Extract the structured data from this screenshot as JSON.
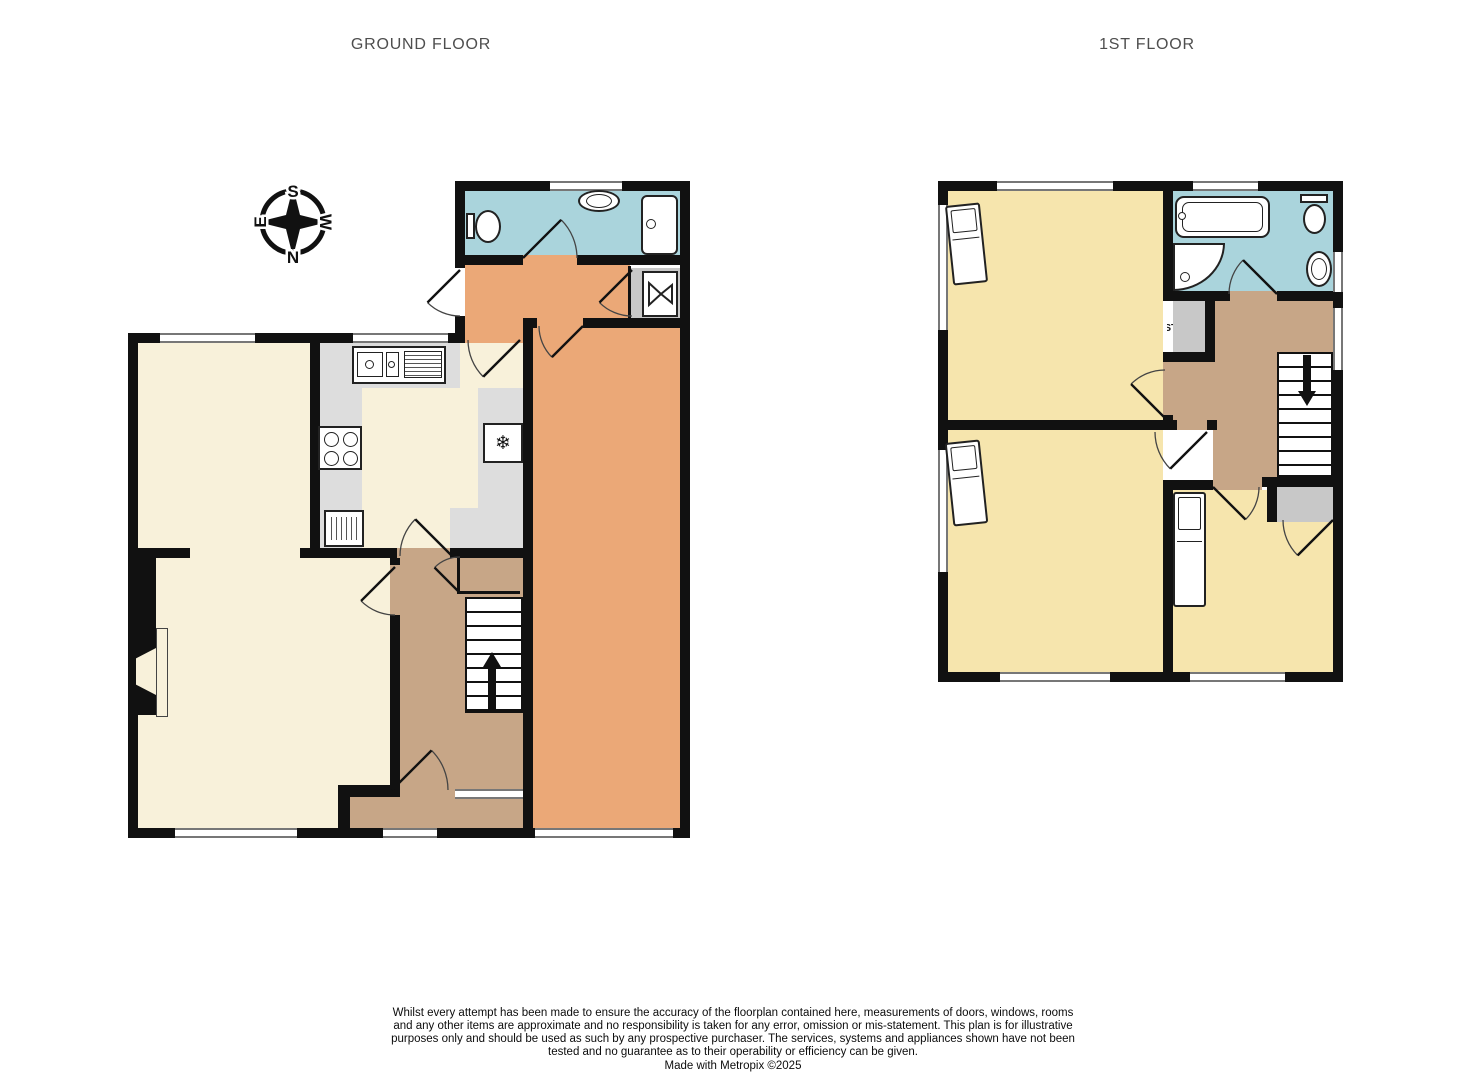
{
  "titles": {
    "ground": "GROUND FLOOR",
    "first": "1ST FLOOR"
  },
  "compass": {
    "north": "N",
    "south": "S",
    "east": "E",
    "west": "W"
  },
  "ground_floor": {
    "wc": "WC",
    "utility": "UTILITY",
    "storage_utility": "STORAGE",
    "garage": "GARAGE",
    "kitchen": "KITCHEN",
    "dining_room": "DINING ROOM",
    "lounge": "LOUNGE",
    "hall": "HALL",
    "storage_hall": "STORAGE",
    "porch": "PORCH",
    "stairs_up": "UP"
  },
  "first_floor": {
    "bedroom1": "BEDROOM 1",
    "bedroom2": "BEDROOM 2",
    "bedroom3": "BEDROOM 3",
    "bathroom": "BATHROOM",
    "landing": "LANDING",
    "storage": "STORAGE",
    "cupboard": "CUPBOARD",
    "stairs_down": "DOWN"
  },
  "footer": {
    "disclaimer": "Whilst every attempt has been made to ensure the accuracy of the floorplan contained here, measurements of doors, windows, rooms and any other items are approximate and no responsibility is taken for any error, omission or mis-statement. This plan is for illustrative purposes only and should be used as such by any prospective purchaser. The services, systems and appliances shown have not been tested and no guarantee as to their operability or efficiency can be given.",
    "credit": "Made with Metropix ©2025"
  },
  "colors": {
    "cream": "#F8F1DA",
    "yellow": "#F6E5AD",
    "blue": "#AAD4DC",
    "tan": "#C7A687",
    "orange": "#EBA877",
    "gray": "#C8C8C8",
    "counter": "#DDDDDD",
    "wall": "#111111"
  }
}
